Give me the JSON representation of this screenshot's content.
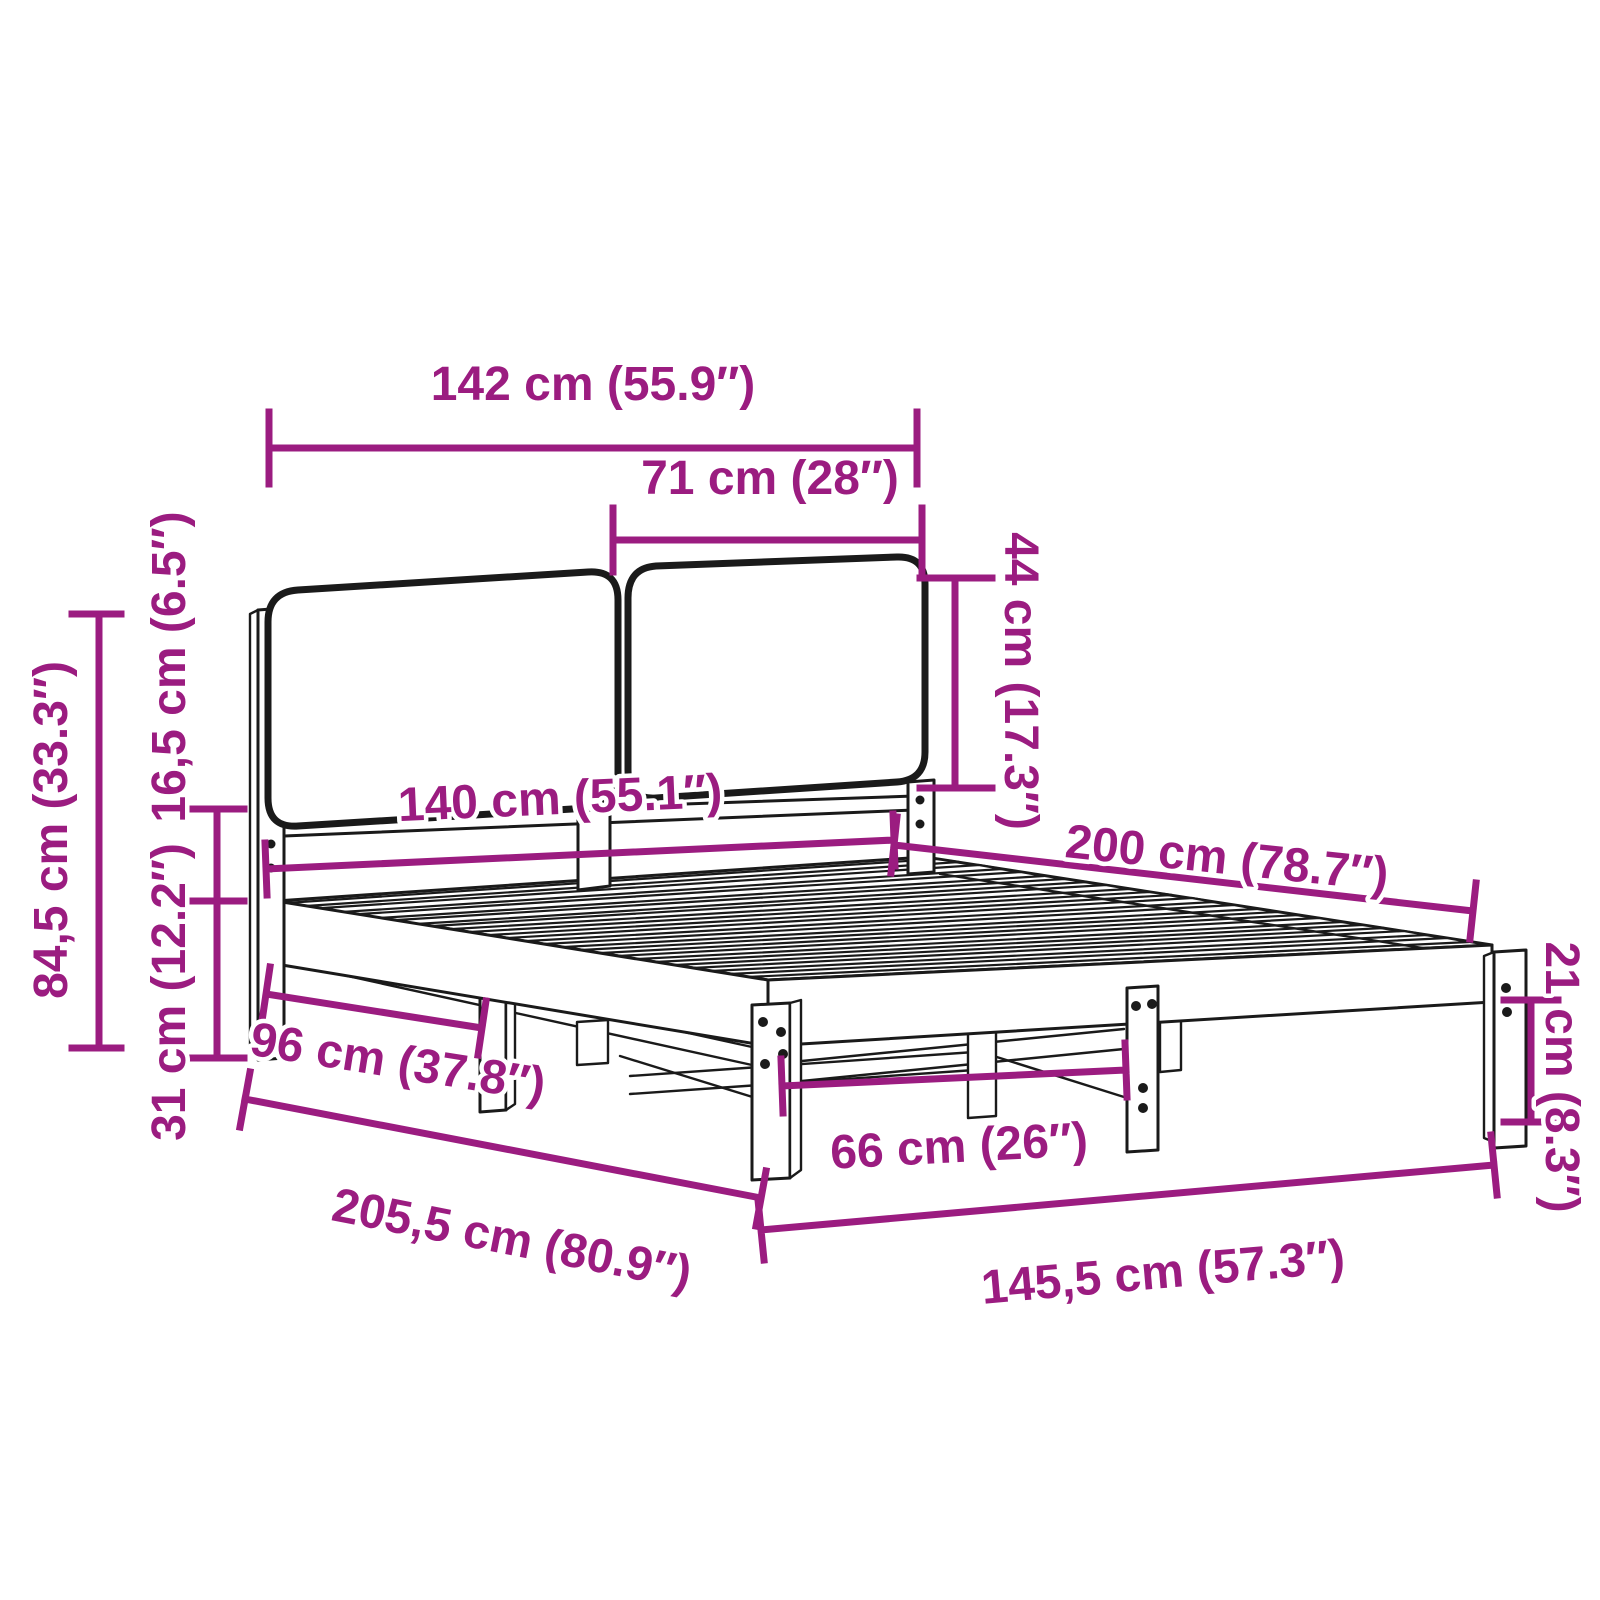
{
  "diagram": {
    "subject": "bed-frame-with-upholstered-headboard-dimension-diagram",
    "background_color": "#ffffff",
    "line_color": "#1a1a1a",
    "accent_color": "#9B1C80",
    "unit_primary": "cm",
    "unit_secondary": "in",
    "dimensions": [
      {
        "id": "headboard-width",
        "cm": "142",
        "in": "55.9",
        "label": "142 cm (55.9″)"
      },
      {
        "id": "cushion-width",
        "cm": "71",
        "in": "28",
        "label": "71 cm (28″)"
      },
      {
        "id": "cushion-height",
        "cm": "44",
        "in": "17.3",
        "label": "44 cm (17.3″)"
      },
      {
        "id": "headboard-total-height",
        "cm": "84,5",
        "in": "33.3",
        "label": "84,5 cm (33.3″)"
      },
      {
        "id": "cushion-panel-depth",
        "cm": "16,5",
        "in": "6.5",
        "label": "16,5 cm (6.5″)"
      },
      {
        "id": "frame-side-height",
        "cm": "31",
        "in": "12.2",
        "label": "31 cm (12.2″)"
      },
      {
        "id": "side-leg-spacing",
        "cm": "96",
        "in": "37.8",
        "label": "96 cm (37.8″)"
      },
      {
        "id": "total-length",
        "cm": "205,5",
        "in": "80.9",
        "label": "205,5 cm (80.9″)"
      },
      {
        "id": "foot-leg-spacing",
        "cm": "66",
        "in": "26",
        "label": "66 cm (26″)"
      },
      {
        "id": "total-width",
        "cm": "145,5",
        "in": "57.3",
        "label": "145,5 cm (57.3″)"
      },
      {
        "id": "mattress-length",
        "cm": "200",
        "in": "78.7",
        "label": "200 cm (78.7″)"
      },
      {
        "id": "mattress-width",
        "cm": "140",
        "in": "55.1",
        "label": "140 cm (55.1″)"
      },
      {
        "id": "leg-height",
        "cm": "21",
        "in": "8.3",
        "label": "21 cm (8.3″)"
      }
    ]
  }
}
